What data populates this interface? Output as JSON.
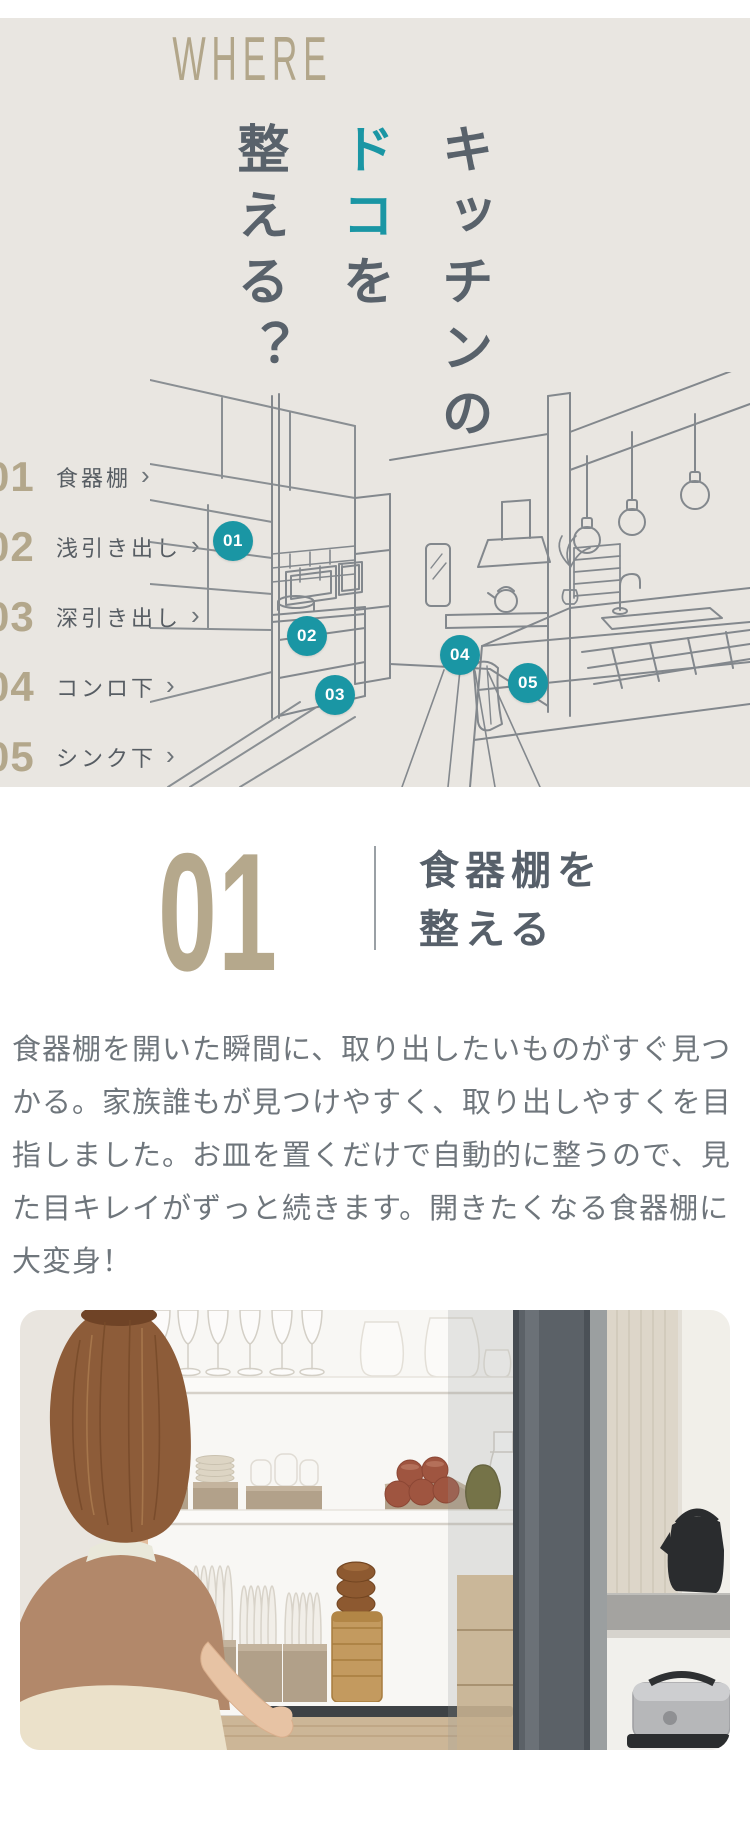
{
  "colors": {
    "hero_bg": "#e9e6e1",
    "tan": "#b3a78b",
    "teal": "#1a96a4",
    "slate": "#57606a",
    "body_text": "#6f767c"
  },
  "hero": {
    "eyebrow": "WHERE",
    "vertical_title": {
      "col_right": "キッチンの",
      "col_mid_accent": "ドコ",
      "col_mid_rest": "を",
      "col_left": "整える？"
    },
    "menu": {
      "chevron": "›",
      "items": [
        {
          "num": "01",
          "label": "食器棚"
        },
        {
          "num": "02",
          "label": "浅引き出し"
        },
        {
          "num": "03",
          "label": "深引き出し"
        },
        {
          "num": "04",
          "label": "コンロ下"
        },
        {
          "num": "05",
          "label": "シンク下"
        }
      ]
    },
    "map_badges": [
      "01",
      "02",
      "03",
      "04",
      "05"
    ]
  },
  "feature": {
    "number": "01",
    "title_line1": "食器棚を",
    "title_line2": "整える",
    "body": "食器棚を開いた瞬間に、取り出したいものがすぐ見つかる。家族誰もが見つけやすく、取り出しやすくを目指しました。お皿を置くだけで自動的に整うので、見た目キレイがずっと続きます。開きたくなる食器棚に大変身！"
  }
}
